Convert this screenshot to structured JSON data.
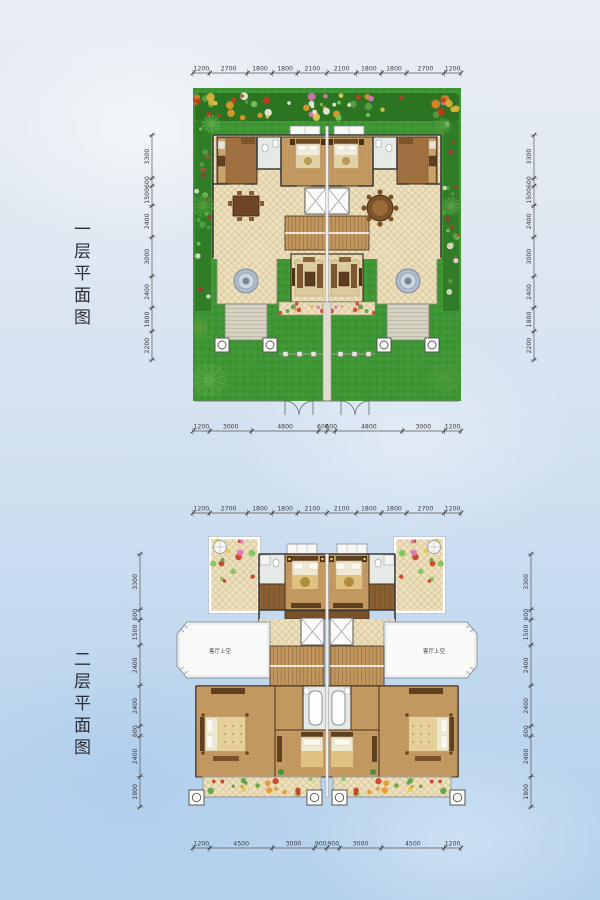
{
  "page": {
    "width": 600,
    "height": 900,
    "background_top": "#e9edf4",
    "background_bottom": "#b4d1ec"
  },
  "plans": [
    {
      "title": "一层平面图",
      "dims": {
        "top": [
          1200,
          2700,
          1800,
          1800,
          2100,
          2100,
          1800,
          1800,
          2700,
          1200
        ],
        "bottom": [
          1200,
          3000,
          4800,
          600,
          600,
          4800,
          3000,
          1200
        ],
        "left": [
          3300,
          600,
          1500,
          2400,
          3000,
          2400,
          1800,
          2200
        ],
        "right": [
          3300,
          600,
          1500,
          2400,
          3000,
          2400,
          1800,
          2200
        ]
      }
    },
    {
      "title": "二层平面图",
      "void_label": "客厅上空",
      "dims": {
        "top": [
          1200,
          2700,
          1800,
          1800,
          2100,
          2100,
          1800,
          1800,
          2700,
          1200
        ],
        "bottom": [
          1200,
          4500,
          3000,
          900,
          900,
          3000,
          4500,
          1200
        ],
        "left": [
          3300,
          600,
          1500,
          2400,
          2400,
          600,
          2400,
          1800
        ],
        "right": [
          3300,
          600,
          1500,
          2400,
          2400,
          600,
          2400,
          1800
        ]
      }
    }
  ],
  "colors": {
    "lawn": "#3f9634",
    "tile": "#ece0bd",
    "wood": "#c49a63",
    "wall": "#3b3b3b",
    "dimension_text": "#3c3c44",
    "background_top": "#e9edf4",
    "background_bottom": "#b4d1ec"
  }
}
